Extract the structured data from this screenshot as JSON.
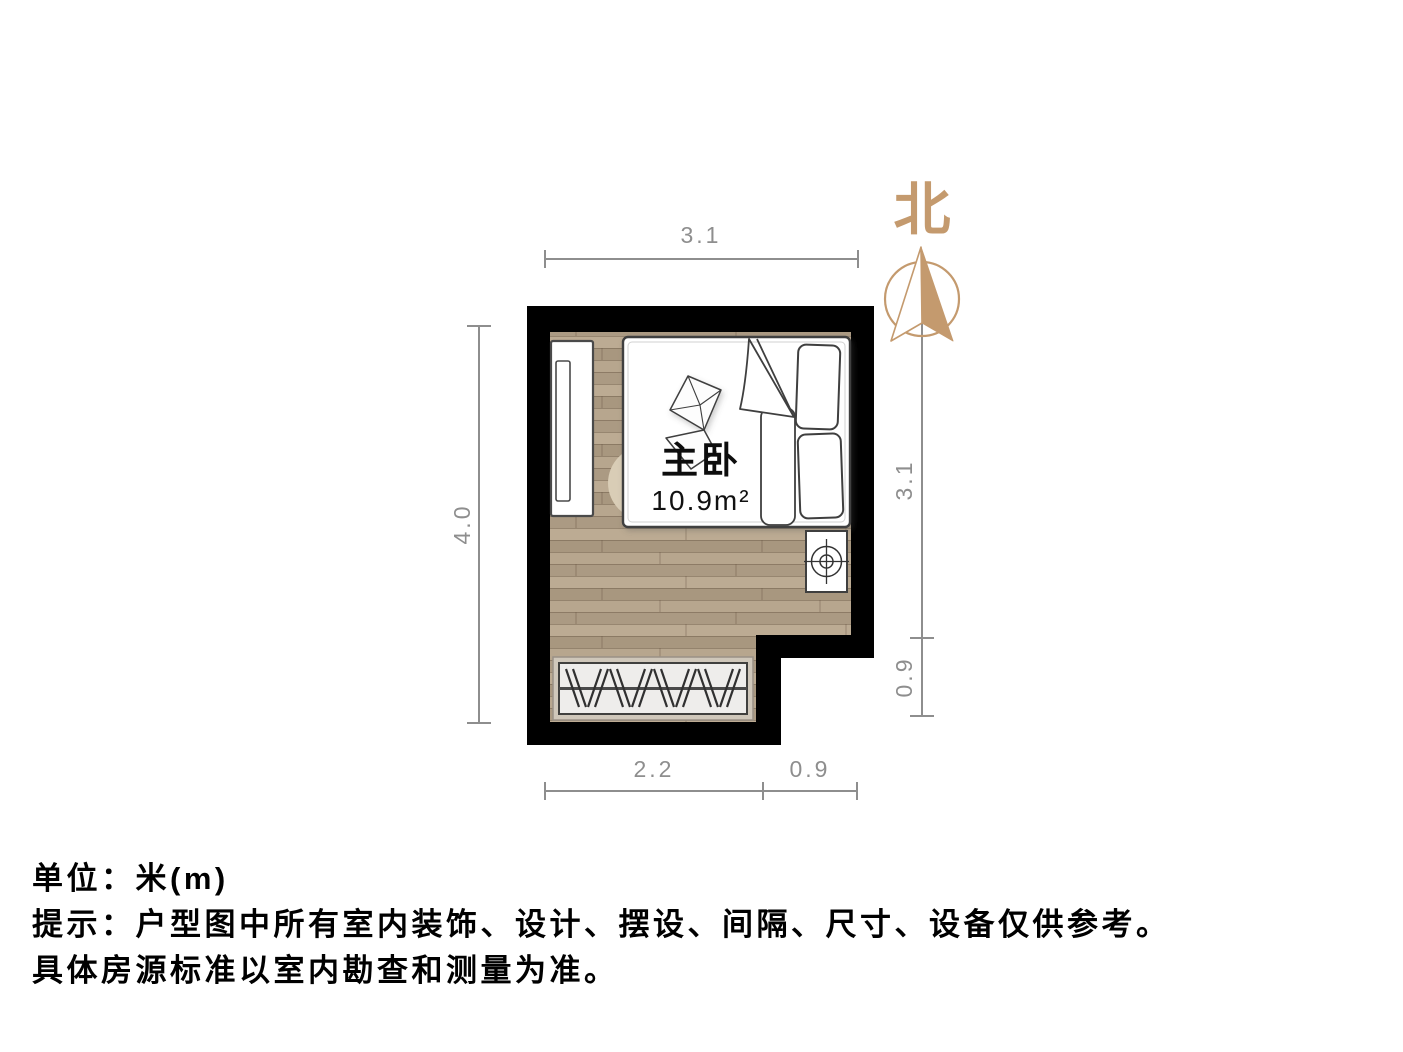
{
  "room": {
    "name": "主卧",
    "area": "10.9m²"
  },
  "compass": {
    "label": "北"
  },
  "dimensions": {
    "unit": "m",
    "top_width": "3.1",
    "left_height": "4.0",
    "right_upper": "3.1",
    "right_lower": "0.9",
    "bottom_inner": "2.2",
    "bottom_outer": "0.9"
  },
  "footer": {
    "unit_line": "单位：米(m)",
    "tip_line": "提示：户型图中所有室内装饰、设计、摆设、间隔、尺寸、设备仅供参考。",
    "note_line": "具体房源标准以室内勘查和测量为准。"
  },
  "icons": {
    "compass_north_icon": "circle-with-north-arrow",
    "bed_icon": "double-bed-top-view",
    "wardrobe_hangers_icon": "closet-with-clothes-hangers",
    "side_cabinet_icon": "tall-cabinet-top-view",
    "ceiling_fixture_icon": "crosshair-circle-fixture"
  },
  "colors": {
    "wall": "#000000",
    "floor_wood": "#b2a089",
    "accent_tan": "#c49a6e",
    "dimension_gray": "#8e8e8e",
    "furniture_outline": "#3f3f3f"
  }
}
